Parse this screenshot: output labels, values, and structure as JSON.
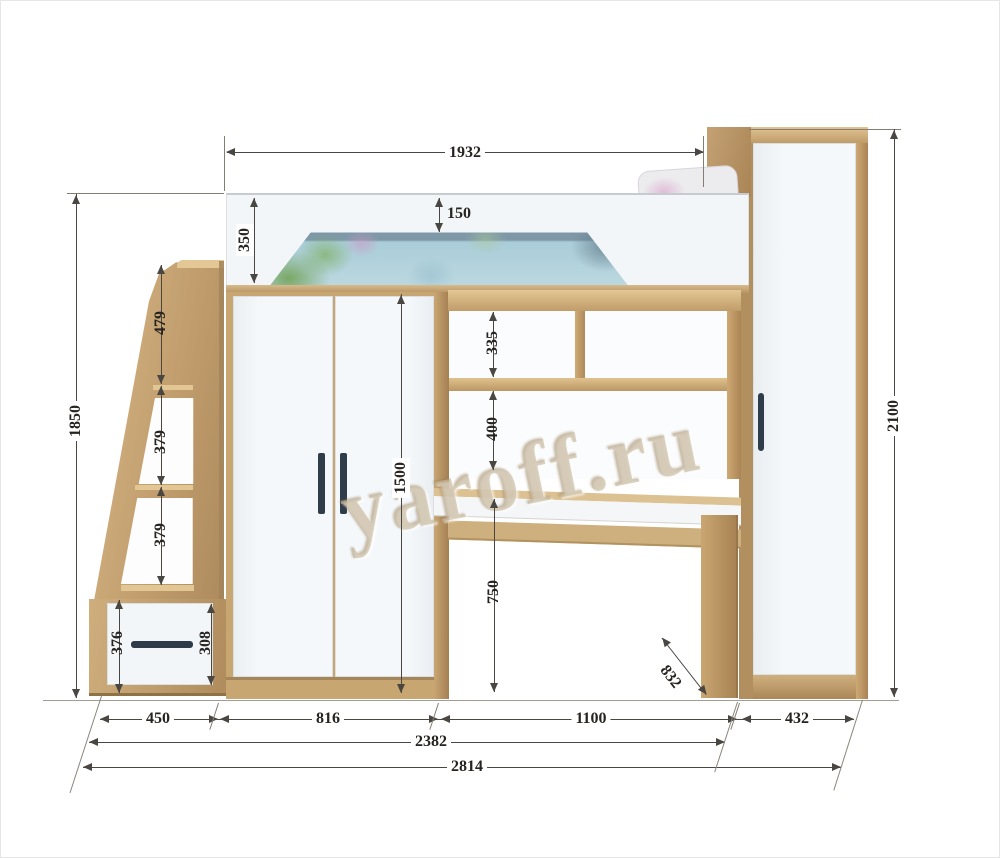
{
  "watermark": {
    "text": "yaroff.ru"
  },
  "colors": {
    "wood": "#c8a672",
    "wood_dark": "#a88353",
    "wood_light": "#e3c794",
    "panel_white": "#f3f6f8",
    "handle": "#2f3c4a",
    "dim_line": "#4a4641",
    "dim_text": "#262320",
    "bedding_blue": "#a9cdd9",
    "bedding_band": "#7e98a8"
  },
  "dims": {
    "bed_length": "1932",
    "overall_height": "2100",
    "left_height": "1850",
    "rail_height": "350",
    "rail_over_mattress": "150",
    "step_top": "479",
    "step_mid": "379",
    "step_low": "379",
    "drawer_front_height": "376",
    "drawer_box_height": "308",
    "shelf_upper": "335",
    "shelf_lower": "400",
    "wardrobe_door_height": "1500",
    "desk_clearance": "750",
    "desk_depth": "832",
    "stairs_width": "450",
    "wardrobe_width": "816",
    "desk_width": "1100",
    "side_wardrobe_width": "432",
    "width_no_side_wardrobe": "2382",
    "overall_width": "2814"
  }
}
